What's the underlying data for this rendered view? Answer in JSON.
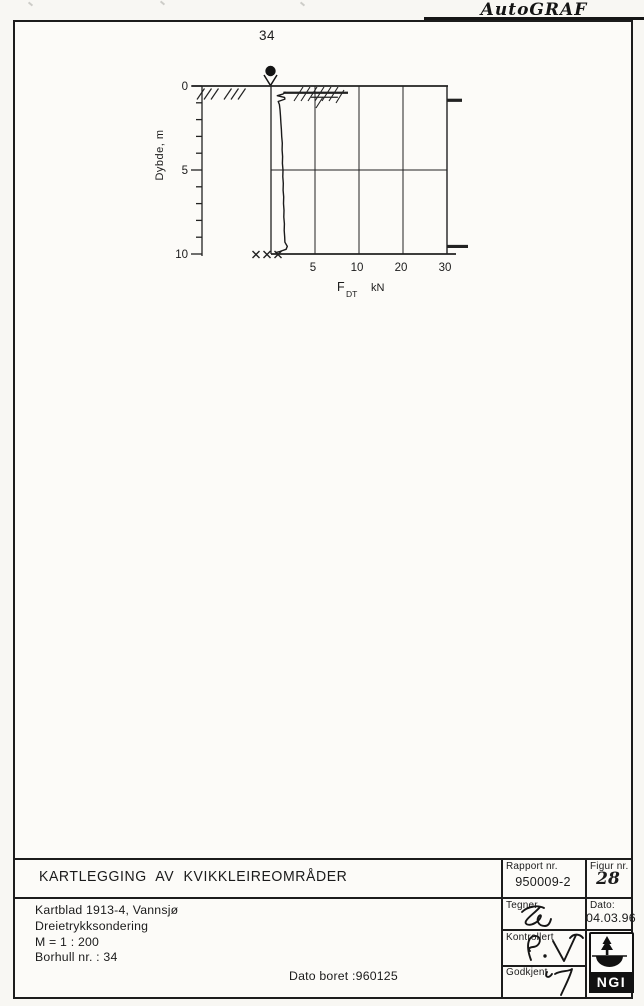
{
  "header": {
    "software_logo": "AutoGRAF"
  },
  "chart_data": {
    "type": "line",
    "borehole_label": "34",
    "ylabel": "Dybde, m",
    "xlabel_main": "F",
    "xlabel_sub": "DT",
    "xlabel_unit": "kN",
    "x_ticks_kN": [
      5,
      10,
      20,
      30
    ],
    "x_scale_breakpoints_kN": [
      0,
      5,
      10,
      20,
      30
    ],
    "depth_major_ticks_m": [
      0,
      5,
      10
    ],
    "depth_minor_step_m": 1,
    "depth_range_m": [
      0,
      10
    ],
    "grid": "on",
    "series": [
      {
        "name": "F_DT",
        "points_depth_kN": [
          [
            0.35,
            1.65
          ],
          [
            0.48,
            1.35
          ],
          [
            0.58,
            0.72
          ],
          [
            0.68,
            1.55
          ],
          [
            0.78,
            1.58
          ],
          [
            0.92,
            0.82
          ],
          [
            1.1,
            0.95
          ],
          [
            1.4,
            1.02
          ],
          [
            1.8,
            1.08
          ],
          [
            2.2,
            1.12
          ],
          [
            2.6,
            1.18
          ],
          [
            3.0,
            1.22
          ],
          [
            3.4,
            1.28
          ],
          [
            3.8,
            1.26
          ],
          [
            4.2,
            1.32
          ],
          [
            4.6,
            1.3
          ],
          [
            5.0,
            1.36
          ],
          [
            5.4,
            1.34
          ],
          [
            5.8,
            1.4
          ],
          [
            6.2,
            1.38
          ],
          [
            6.6,
            1.44
          ],
          [
            7.0,
            1.42
          ],
          [
            7.4,
            1.48
          ],
          [
            7.8,
            1.46
          ],
          [
            8.2,
            1.52
          ],
          [
            8.6,
            1.5
          ],
          [
            9.0,
            1.56
          ],
          [
            9.3,
            1.58
          ],
          [
            9.55,
            1.85
          ],
          [
            9.72,
            1.72
          ],
          [
            9.85,
            1.0
          ],
          [
            9.92,
            0.5
          ]
        ]
      }
    ],
    "surface_spikes": [
      {
        "depth_m": 0.4,
        "from_kN": 1.4,
        "to_kN": 8.75
      },
      {
        "depth_m": 0.67,
        "from_kN": 4.55,
        "to_kN": 7.6
      }
    ],
    "right_margin_marker_depths_m": [
      0.85,
      9.55
    ],
    "end_refusal_marks_count": 3
  },
  "title_block": {
    "project_title": "KARTLEGGING AV KVIKKLEIREOMRÅDER",
    "rapport_label": "Rapport nr.",
    "rapport_value": "950009-2",
    "figur_label": "Figur nr.",
    "figur_value": "28",
    "info_line1": "Kartblad 1913-4, Vannsjø",
    "info_line2": "Dreietrykksondering",
    "info_line3": "M = 1 : 200",
    "info_line4": "Borhull nr. : 34",
    "dato_boret": "Dato boret :960125",
    "tegner_label": "Tegner",
    "dato_label": "Dato:",
    "dato_value": "04.03.96",
    "kontrollert_label": "Kontrollert",
    "godkjent_label": "Godkjent",
    "ngi_logo_text": "NGI"
  }
}
